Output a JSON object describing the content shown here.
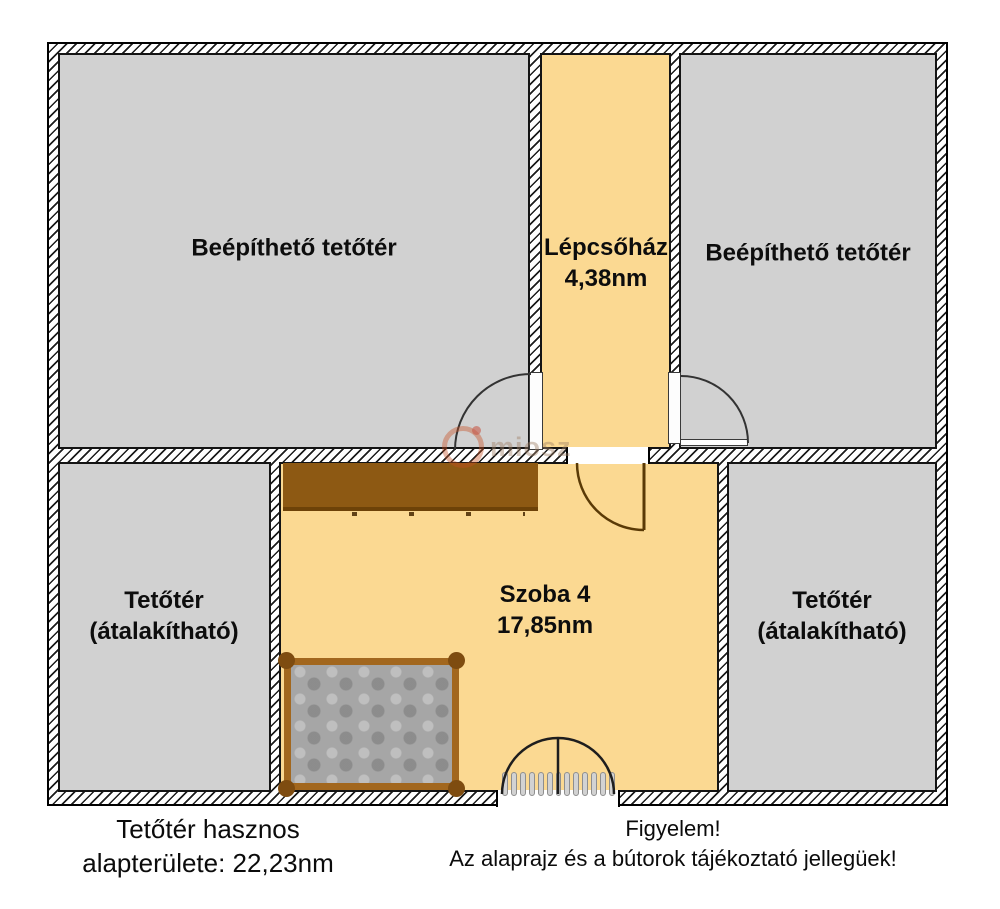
{
  "plan_title": "attic floor plan",
  "colors": {
    "room_gray": "#d1d1d1",
    "room_cream": "#fbd992",
    "wardrobe_brown": "#8d5913",
    "bed_frame_brown": "#a2671e",
    "wall_hatch": "#1c1c1c",
    "watermark_orange": "#c64d20"
  },
  "rooms": [
    {
      "id": "top-left",
      "label": "Beépíthető tetőtér"
    },
    {
      "id": "staircase",
      "label": "Lépcsőház",
      "area": "4,38nm"
    },
    {
      "id": "top-right",
      "label": "Beépíthető tetőtér"
    },
    {
      "id": "bottom-left",
      "label": "Tetőtér",
      "label2": "(átalakítható)"
    },
    {
      "id": "szoba4",
      "label": "Szoba 4",
      "area": "17,85nm"
    },
    {
      "id": "bottom-right",
      "label": "Tetőtér",
      "label2": "(átalakítható)"
    }
  ],
  "footer": {
    "left_line1": "Tetőtér hasznos",
    "left_line2": "alapterülete: 22,23nm",
    "right_line1": "Figyelem!",
    "right_line2": "Az alaprajz és a bútorok tájékoztató jellegüek!"
  },
  "watermark": {
    "text": "miosz"
  }
}
